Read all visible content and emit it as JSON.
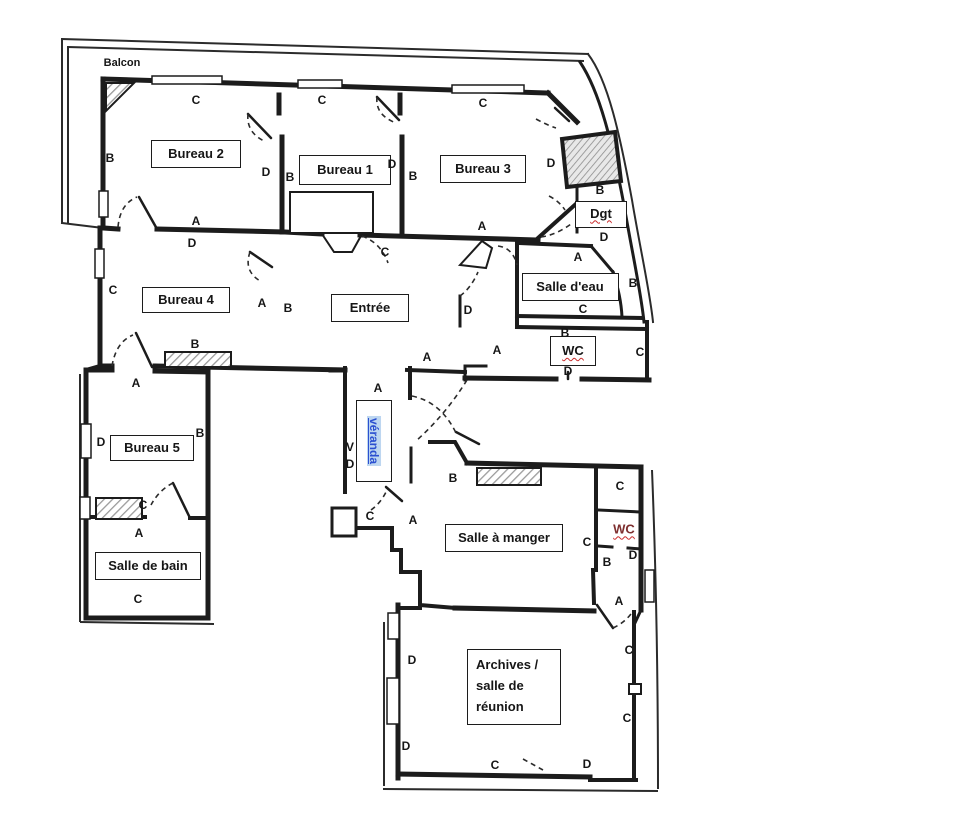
{
  "page": {
    "background": "#ffffff",
    "ink": "#1c1c1c",
    "spellcheck_red": "#c92a2a",
    "link_blue": "#2b4fd0",
    "highlight_blue": "#bdd6f0"
  },
  "rooms": [
    {
      "id": "balcon",
      "label": "Balcon",
      "x": 122,
      "y": 63,
      "style": "plain small"
    },
    {
      "id": "bureau-2",
      "label": "Bureau 2",
      "x": 196,
      "y": 154,
      "w": 90,
      "h": 28,
      "style": ""
    },
    {
      "id": "bureau-1",
      "label": "Bureau 1",
      "x": 345,
      "y": 170,
      "w": 92,
      "h": 30,
      "style": ""
    },
    {
      "id": "bureau-3",
      "label": "Bureau 3",
      "x": 483,
      "y": 169,
      "w": 86,
      "h": 28,
      "style": ""
    },
    {
      "id": "bureau-4",
      "label": "Bureau 4",
      "x": 186,
      "y": 300,
      "w": 88,
      "h": 26,
      "style": ""
    },
    {
      "id": "entree",
      "label": "Entrée",
      "x": 370,
      "y": 308,
      "w": 78,
      "h": 28,
      "style": ""
    },
    {
      "id": "salle-d-eau",
      "label": "Salle d'eau",
      "x": 570,
      "y": 287,
      "w": 97,
      "h": 28,
      "style": ""
    },
    {
      "id": "dgt",
      "label": "Dgt",
      "x": 601,
      "y": 214,
      "w": 52,
      "h": 27,
      "style": "wavy"
    },
    {
      "id": "wc-middle",
      "label": "WC",
      "x": 573,
      "y": 351,
      "w": 46,
      "h": 30,
      "style": "wavy"
    },
    {
      "id": "bureau-5",
      "label": "Bureau 5",
      "x": 152,
      "y": 448,
      "w": 84,
      "h": 26,
      "style": ""
    },
    {
      "id": "salle-de-bain",
      "label": "Salle de bain",
      "x": 148,
      "y": 566,
      "w": 106,
      "h": 28,
      "style": ""
    },
    {
      "id": "salle-a-manger",
      "label": "Salle à manger",
      "x": 504,
      "y": 538,
      "w": 118,
      "h": 28,
      "style": ""
    },
    {
      "id": "archives",
      "label": "Archives /\nsalle de\nréunion",
      "x": 514,
      "y": 687,
      "w": 94,
      "h": 76,
      "style": "multiline"
    },
    {
      "id": "wc-salle-a-manger",
      "label": "WC",
      "x": 624,
      "y": 529,
      "style": "plain wavy red"
    },
    {
      "id": "veranda",
      "label": "véranda",
      "x": 374,
      "y": 441,
      "w": 36,
      "h": 82,
      "style": "veranda"
    }
  ],
  "wall_letters": [
    {
      "t": "C",
      "x": 196,
      "y": 100
    },
    {
      "t": "C",
      "x": 322,
      "y": 100
    },
    {
      "t": "C",
      "x": 483,
      "y": 103
    },
    {
      "t": "B",
      "x": 110,
      "y": 158
    },
    {
      "t": "D",
      "x": 266,
      "y": 172
    },
    {
      "t": "B",
      "x": 290,
      "y": 177
    },
    {
      "t": "D",
      "x": 392,
      "y": 164
    },
    {
      "t": "B",
      "x": 413,
      "y": 176
    },
    {
      "t": "D",
      "x": 551,
      "y": 163
    },
    {
      "t": "B",
      "x": 600,
      "y": 190
    },
    {
      "t": "A",
      "x": 196,
      "y": 221
    },
    {
      "t": "D",
      "x": 192,
      "y": 243
    },
    {
      "t": "A",
      "x": 482,
      "y": 226
    },
    {
      "t": "D",
      "x": 604,
      "y": 237
    },
    {
      "t": "A",
      "x": 578,
      "y": 257
    },
    {
      "t": "B",
      "x": 633,
      "y": 283
    },
    {
      "t": "C",
      "x": 583,
      "y": 309
    },
    {
      "t": "C",
      "x": 385,
      "y": 252
    },
    {
      "t": "C",
      "x": 113,
      "y": 290
    },
    {
      "t": "A",
      "x": 262,
      "y": 303
    },
    {
      "t": "B",
      "x": 288,
      "y": 308
    },
    {
      "t": "D",
      "x": 468,
      "y": 310
    },
    {
      "t": "B",
      "x": 195,
      "y": 344
    },
    {
      "t": "B",
      "x": 565,
      "y": 333
    },
    {
      "t": "C",
      "x": 640,
      "y": 352
    },
    {
      "t": "D",
      "x": 568,
      "y": 371
    },
    {
      "t": "A",
      "x": 497,
      "y": 350
    },
    {
      "t": "A",
      "x": 427,
      "y": 357
    },
    {
      "t": "A",
      "x": 136,
      "y": 383
    },
    {
      "t": "A",
      "x": 378,
      "y": 388
    },
    {
      "t": "D",
      "x": 101,
      "y": 442
    },
    {
      "t": "B",
      "x": 200,
      "y": 433
    },
    {
      "t": "V",
      "x": 350,
      "y": 447
    },
    {
      "t": "D",
      "x": 350,
      "y": 464
    },
    {
      "t": "C",
      "x": 143,
      "y": 505
    },
    {
      "t": "A",
      "x": 139,
      "y": 533
    },
    {
      "t": "C",
      "x": 370,
      "y": 516
    },
    {
      "t": "A",
      "x": 413,
      "y": 520
    },
    {
      "t": "B",
      "x": 453,
      "y": 478
    },
    {
      "t": "C",
      "x": 620,
      "y": 486
    },
    {
      "t": "C",
      "x": 587,
      "y": 542
    },
    {
      "t": "B",
      "x": 607,
      "y": 562
    },
    {
      "t": "D",
      "x": 633,
      "y": 555
    },
    {
      "t": "A",
      "x": 619,
      "y": 601
    },
    {
      "t": "C",
      "x": 138,
      "y": 599
    },
    {
      "t": "D",
      "x": 412,
      "y": 660
    },
    {
      "t": "D",
      "x": 406,
      "y": 746
    },
    {
      "t": "C",
      "x": 629,
      "y": 650
    },
    {
      "t": "C",
      "x": 627,
      "y": 718
    },
    {
      "t": "C",
      "x": 495,
      "y": 765
    },
    {
      "t": "D",
      "x": 587,
      "y": 764
    }
  ]
}
